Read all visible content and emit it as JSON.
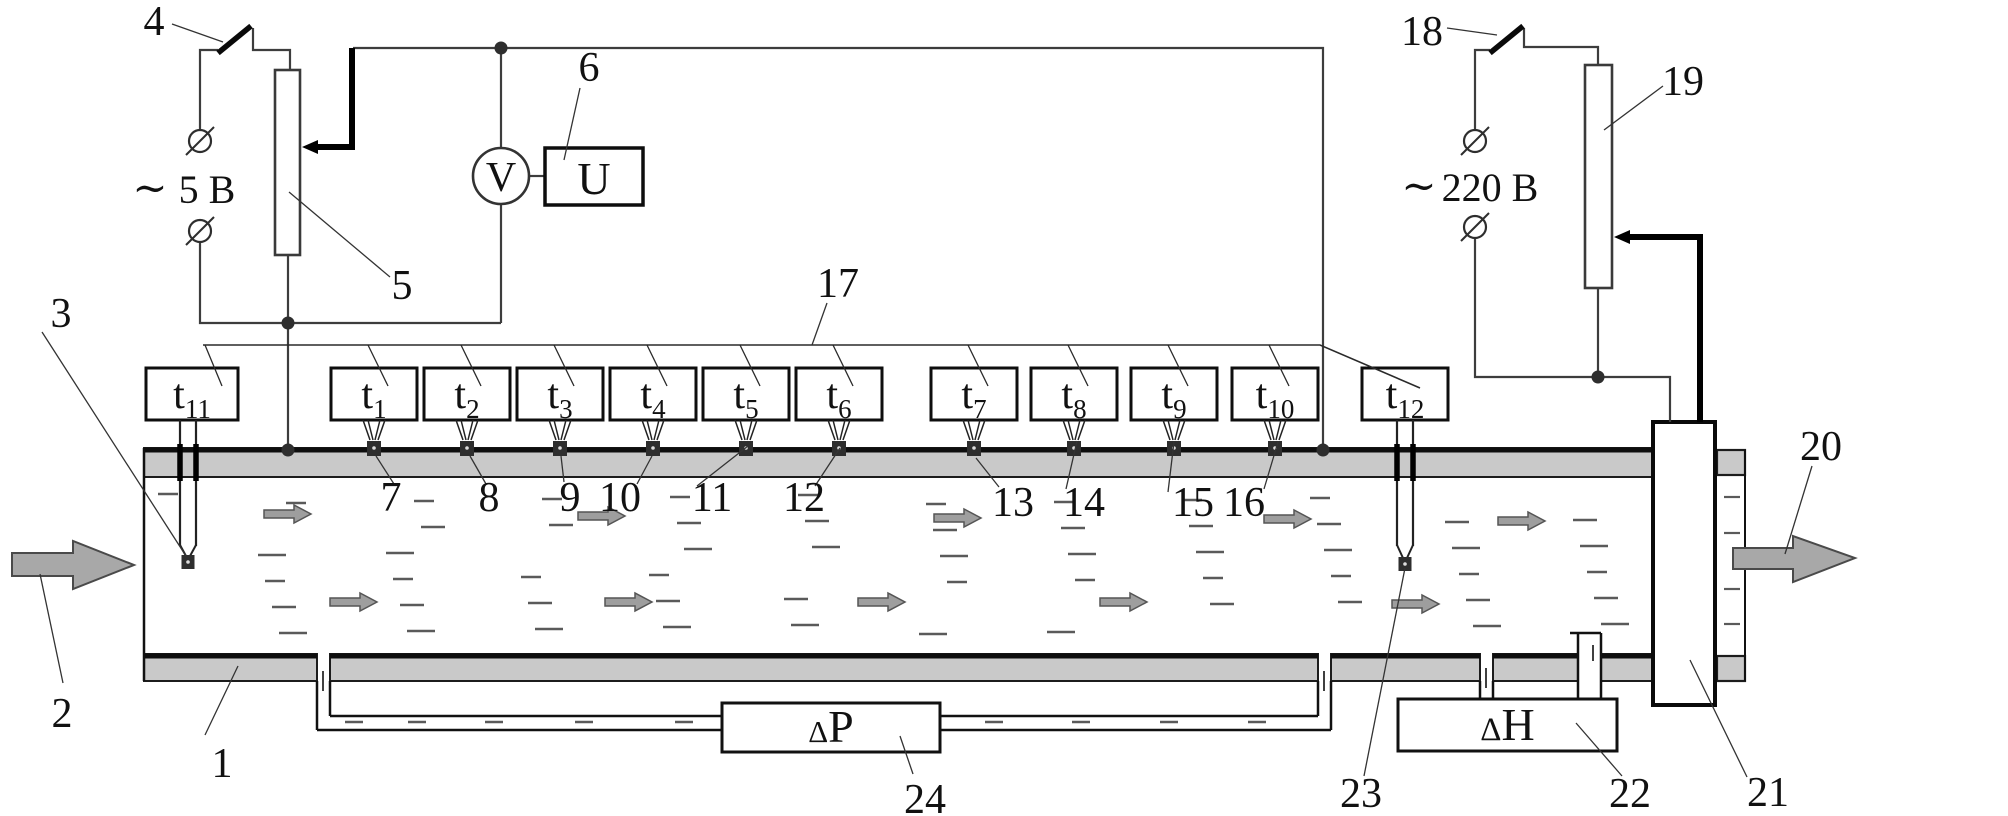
{
  "diagram": {
    "canvas": {
      "w": 2008,
      "h": 816,
      "bg": "#ffffff"
    },
    "palette": {
      "wall_fill": "#c9c9c9",
      "line": "#1c1c1c",
      "wire": "#3d3d3d",
      "thick_wire": "#000000",
      "arrow_fill": "#a8a8a8",
      "arrow_stroke": "#4a4a4a",
      "small_arrow_fill": "#9e9e9e",
      "dash": "#5a5a5a",
      "junction": "#2e2e2e"
    },
    "texts": {
      "voltmeter": "V",
      "u_display": "U",
      "low_voltage_tilde": "∼",
      "low_voltage": "5 В",
      "high_voltage_tilde": "∼",
      "high_voltage": "220 В",
      "dp_delta": "Δ",
      "dp_letter": "P",
      "dh_delta": "Δ",
      "dh_letter": "H",
      "sensor_prefix": "t"
    },
    "volt_labels": [
      {
        "tilde": [
          150,
          202
        ],
        "pos": [
          207,
          203
        ],
        "key": "low_voltage",
        "tkey": "low_voltage_tilde",
        "name": "voltage-label-5v"
      },
      {
        "tilde": [
          1419,
          200
        ],
        "pos": [
          1490,
          201
        ],
        "key": "high_voltage",
        "tkey": "high_voltage_tilde",
        "name": "voltage-label-220v"
      }
    ],
    "pipe": {
      "top_wall": [
        144,
        448,
        1509,
        29
      ],
      "bottom_walls": [
        [
          144,
          654,
          173,
          27
        ],
        [
          330,
          654,
          988,
          27
        ],
        [
          1331,
          654,
          149,
          27
        ],
        [
          1493,
          654,
          85,
          27
        ],
        [
          1601,
          654,
          52,
          27
        ]
      ],
      "stub_walls": [
        [
          1717,
          450,
          28,
          25
        ],
        [
          1717,
          656,
          28,
          25
        ]
      ],
      "left_edge": [
        144,
        448,
        144,
        681
      ],
      "stub_edge": [
        1745,
        450,
        1745,
        681
      ],
      "thick_edges": [
        [
          144,
          450,
          1653,
          450
        ],
        [
          144,
          656,
          317,
          656
        ],
        [
          330,
          656,
          1318,
          656
        ],
        [
          1331,
          656,
          1480,
          656
        ],
        [
          1493,
          656,
          1578,
          656
        ],
        [
          1601,
          656,
          1653,
          656
        ]
      ]
    },
    "unit21": [
      1653,
      422,
      62,
      283
    ],
    "meters": {
      "dp_box": [
        722,
        703,
        218,
        49
      ],
      "dh_box": [
        1398,
        699,
        219,
        52
      ],
      "u_box": [
        545,
        148,
        98,
        57
      ],
      "v_circle": [
        501,
        176,
        28
      ]
    },
    "rheostats": {
      "r5": [
        275,
        70,
        25,
        185
      ],
      "r19": [
        1585,
        65,
        27,
        223
      ]
    },
    "wipers": [
      {
        "tip": [
          302,
          147
        ],
        "back": 16,
        "wire": [
          [
            316,
            147
          ],
          [
            352,
            147
          ],
          [
            352,
            48
          ]
        ]
      },
      {
        "tip": [
          1614,
          237
        ],
        "back": 16,
        "wire": [
          [
            1628,
            237
          ],
          [
            1700,
            237
          ],
          [
            1700,
            422
          ]
        ]
      }
    ],
    "switch_blades": [
      [
        218,
        53,
        251,
        26
      ],
      [
        1490,
        53,
        1523,
        26
      ]
    ],
    "wires": [
      [
        [
          200,
          129
        ],
        [
          200,
          50
        ],
        [
          218,
          50
        ]
      ],
      [
        [
          253,
          28
        ],
        [
          253,
          50
        ],
        [
          290,
          50
        ],
        [
          290,
          70
        ]
      ],
      [
        [
          200,
          243
        ],
        [
          200,
          323
        ],
        [
          501,
          323
        ]
      ],
      [
        [
          288,
          255
        ],
        [
          288,
          450
        ]
      ],
      [
        [
          501,
          204
        ],
        [
          501,
          323
        ]
      ],
      [
        [
          501,
          148
        ],
        [
          501,
          48
        ]
      ],
      [
        [
          353,
          48
        ],
        [
          1323,
          48
        ],
        [
          1323,
          450
        ]
      ],
      [
        [
          529,
          176
        ],
        [
          545,
          176
        ]
      ],
      [
        [
          1475,
          129
        ],
        [
          1475,
          50
        ],
        [
          1490,
          50
        ]
      ],
      [
        [
          1524,
          28
        ],
        [
          1524,
          47
        ],
        [
          1598,
          47
        ],
        [
          1598,
          65
        ]
      ],
      [
        [
          1598,
          288
        ],
        [
          1598,
          377
        ]
      ],
      [
        [
          1475,
          239
        ],
        [
          1475,
          377
        ],
        [
          1670,
          377
        ],
        [
          1670,
          422
        ]
      ]
    ],
    "terminals": [
      [
        200,
        141
      ],
      [
        200,
        231
      ],
      [
        1475,
        141
      ],
      [
        1475,
        227
      ]
    ],
    "junctions": [
      [
        288,
        323
      ],
      [
        501,
        48
      ],
      [
        288,
        450
      ],
      [
        1323,
        450
      ],
      [
        1598,
        377
      ]
    ],
    "bus": {
      "poly": [
        [
          203,
          345
        ],
        [
          1320,
          345
        ],
        [
          1420,
          388
        ]
      ],
      "leaders": [
        [
          205,
          345,
          222,
          386
        ],
        [
          368,
          345,
          388,
          386
        ],
        [
          461,
          345,
          481,
          386
        ],
        [
          554,
          345,
          574,
          386
        ],
        [
          647,
          345,
          667,
          386
        ],
        [
          740,
          345,
          760,
          386
        ],
        [
          833,
          345,
          853,
          386
        ],
        [
          968,
          345,
          988,
          386
        ],
        [
          1068,
          345,
          1088,
          386
        ],
        [
          1168,
          345,
          1188,
          386
        ],
        [
          1269,
          345,
          1289,
          386
        ]
      ]
    },
    "sensors": [
      {
        "sub": "11",
        "box": [
          146,
          368,
          92,
          52
        ],
        "type": "probe",
        "px": [
          180,
          196
        ],
        "jxy": [
          188,
          562
        ]
      },
      {
        "sub": "1",
        "type": "surface",
        "jx": 374
      },
      {
        "sub": "2",
        "type": "surface",
        "jx": 467
      },
      {
        "sub": "3",
        "type": "surface",
        "jx": 560
      },
      {
        "sub": "4",
        "type": "surface",
        "jx": 653
      },
      {
        "sub": "5",
        "type": "surface",
        "jx": 746
      },
      {
        "sub": "6",
        "type": "surface",
        "jx": 839
      },
      {
        "sub": "7",
        "type": "surface",
        "jx": 974
      },
      {
        "sub": "8",
        "type": "surface",
        "jx": 1074
      },
      {
        "sub": "9",
        "type": "surface",
        "jx": 1174
      },
      {
        "sub": "10",
        "type": "surface",
        "jx": 1275
      },
      {
        "sub": "12",
        "box": [
          1362,
          368,
          86,
          52
        ],
        "type": "probe",
        "px": [
          1397,
          1413
        ],
        "jxy": [
          1405,
          564
        ]
      }
    ],
    "tube": {
      "lines": [
        [
          317,
          681,
          317,
          730
        ],
        [
          317,
          730,
          1331,
          730
        ],
        [
          1331,
          681,
          1331,
          730
        ],
        [
          330,
          681,
          330,
          716
        ],
        [
          330,
          716,
          1318,
          716
        ],
        [
          1318,
          681,
          1318,
          716
        ]
      ],
      "ticks": [
        [
          323,
          671,
          323,
          691
        ],
        [
          1324,
          671,
          1324,
          691
        ],
        [
          1486,
          668,
          1486,
          688
        ],
        [
          1593,
          645,
          1593,
          661
        ]
      ],
      "dh_taps": [
        [
          1480,
          681,
          1480,
          699
        ],
        [
          1493,
          681,
          1493,
          699
        ]
      ],
      "pitot": [
        [
          1578,
          633,
          1578,
          699
        ],
        [
          1601,
          633,
          1601,
          699
        ],
        [
          1570,
          633,
          1601,
          633
        ]
      ],
      "dashes": [
        [
          345,
          722
        ],
        [
          408,
          722
        ],
        [
          485,
          722
        ],
        [
          575,
          722
        ],
        [
          675,
          722
        ],
        [
          985,
          722
        ],
        [
          1072,
          722
        ],
        [
          1160,
          722
        ],
        [
          1248,
          722
        ]
      ]
    },
    "flow": {
      "inlet": [
        [
          12,
          553
        ],
        [
          73,
          553
        ],
        [
          73,
          541
        ],
        [
          134,
          565
        ],
        [
          73,
          589
        ],
        [
          73,
          576
        ],
        [
          12,
          576
        ]
      ],
      "outlet": [
        [
          1733,
          548
        ],
        [
          1793,
          548
        ],
        [
          1793,
          536
        ],
        [
          1855,
          558
        ],
        [
          1793,
          582
        ],
        [
          1793,
          569
        ],
        [
          1733,
          569
        ]
      ],
      "small_arrows": [
        [
          264,
          514
        ],
        [
          578,
          516
        ],
        [
          934,
          518
        ],
        [
          1264,
          519
        ],
        [
          1498,
          521
        ],
        [
          330,
          602
        ],
        [
          605,
          602
        ],
        [
          858,
          602
        ],
        [
          1100,
          602
        ],
        [
          1392,
          604
        ]
      ],
      "stub_dashes": [
        [
          1724,
          497
        ],
        [
          1724,
          533
        ],
        [
          1724,
          589
        ],
        [
          1724,
          624
        ]
      ]
    },
    "callouts": [
      {
        "n": "1",
        "x": 222,
        "y": 777,
        "line": [
          205,
          735,
          238,
          666
        ]
      },
      {
        "n": "2",
        "x": 62,
        "y": 727,
        "line": [
          63,
          683,
          40,
          574
        ]
      },
      {
        "n": "3",
        "x": 61,
        "y": 327,
        "line": [
          42,
          332,
          186,
          556
        ]
      },
      {
        "n": "4",
        "x": 154,
        "y": 35,
        "line": [
          172,
          24,
          223,
          42
        ]
      },
      {
        "n": "5",
        "x": 402,
        "y": 299,
        "line": [
          390,
          277,
          289,
          192
        ]
      },
      {
        "n": "6",
        "x": 589,
        "y": 81,
        "line": [
          580,
          88,
          564,
          160
        ]
      },
      {
        "n": "7",
        "x": 391,
        "y": 511,
        "line": [
          394,
          484,
          376,
          456
        ]
      },
      {
        "n": "8",
        "x": 489,
        "y": 511,
        "line": [
          486,
          484,
          470,
          456
        ]
      },
      {
        "n": "9",
        "x": 570,
        "y": 511,
        "line": [
          564,
          482,
          561,
          456
        ]
      },
      {
        "n": "10",
        "x": 620,
        "y": 511,
        "line": [
          637,
          484,
          652,
          456
        ]
      },
      {
        "n": "11",
        "x": 712,
        "y": 511,
        "line": [
          697,
          486,
          748,
          446
        ]
      },
      {
        "n": "12",
        "x": 804,
        "y": 511,
        "line": [
          815,
          486,
          840,
          448
        ]
      },
      {
        "n": "13",
        "x": 1013,
        "y": 516,
        "line": [
          999,
          487,
          976,
          458
        ]
      },
      {
        "n": "14",
        "x": 1084,
        "y": 516,
        "line": [
          1066,
          489,
          1077,
          441
        ]
      },
      {
        "n": "15",
        "x": 1193,
        "y": 516,
        "line": [
          1168,
          492,
          1174,
          442
        ]
      },
      {
        "n": "16",
        "x": 1244,
        "y": 516,
        "line": [
          1264,
          489,
          1278,
          442
        ]
      },
      {
        "n": "17",
        "x": 838,
        "y": 297,
        "line": [
          827,
          303,
          812,
          345
        ]
      },
      {
        "n": "18",
        "x": 1422,
        "y": 45,
        "line": [
          1447,
          28,
          1497,
          35
        ]
      },
      {
        "n": "19",
        "x": 1683,
        "y": 95,
        "line": [
          1663,
          86,
          1604,
          130
        ]
      },
      {
        "n": "20",
        "x": 1821,
        "y": 460,
        "line": [
          1812,
          466,
          1785,
          554
        ]
      },
      {
        "n": "21",
        "x": 1768,
        "y": 806,
        "line": [
          1747,
          777,
          1690,
          660
        ]
      },
      {
        "n": "22",
        "x": 1630,
        "y": 807,
        "line": [
          1622,
          776,
          1576,
          723
        ]
      },
      {
        "n": "23",
        "x": 1361,
        "y": 807,
        "line": [
          1364,
          776,
          1405,
          568
        ]
      },
      {
        "n": "24",
        "x": 925,
        "y": 813,
        "line": [
          913,
          774,
          900,
          736
        ]
      }
    ]
  }
}
